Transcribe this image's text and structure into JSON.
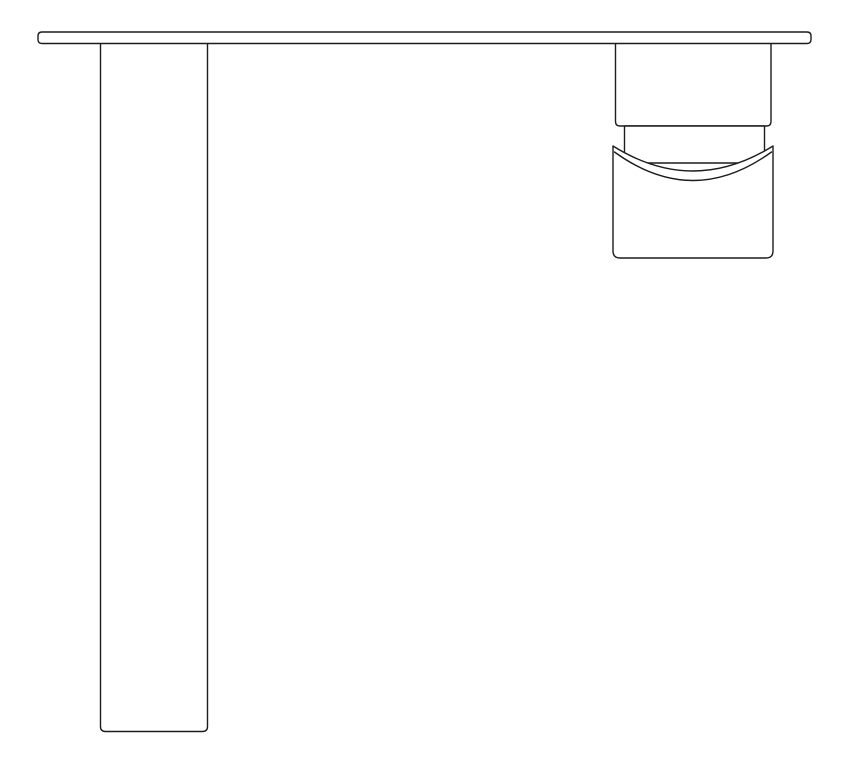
{
  "drawing": {
    "background": "#ffffff",
    "stroke_color": "#1c1c1c",
    "fill_color": "#ffffff",
    "stroke_width": 1.4,
    "viewbox": "0 0 848 768",
    "components": [
      {
        "label": "lever-handle",
        "d": "M 100.5 39 L 100.5 726.5 Q 100.5 731.5 105.5 731.5 L 202.5 731.5 Q 207.5 731.5 207.5 726.5 L 207.5 39 Z"
      },
      {
        "label": "spout-body",
        "d": "M 615.5 39 L 615.5 121.5 Q 615.5 126 620 126 L 766.5 126 Q 771 126 771 121.5 L 771 39 Z"
      },
      {
        "label": "spout-neck",
        "d": "M 624.5 126 L 624.5 163 L 764.5 163 L 764.5 126 Z"
      },
      {
        "label": "spout-collar",
        "d": "M 613 146 L 613 251 Q 613 258 620 258 L 766 258 Q 773 258 773 251 L 773 146 Q 693 196 613 146 Z"
      },
      {
        "label": "aerator-rim-line",
        "d": "M 614.5 152 Q 693 209 771.5 152"
      },
      {
        "label": "mounting-plate",
        "d": "M 42 32 L 807 32 Q 811 32 811 36 L 811 39.5 Q 811 43.5 807 43.5 L 42 43.5 Q 38 43.5 38 39.5 L 38 36 Q 38 32 42 32 Z"
      }
    ]
  }
}
